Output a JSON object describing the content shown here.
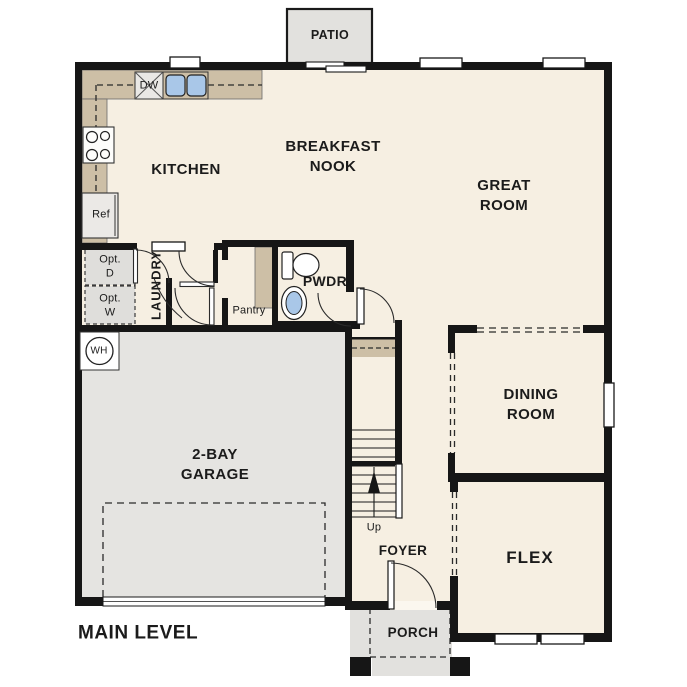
{
  "title": "MAIN LEVEL",
  "plan": {
    "level_label": "MAIN LEVEL",
    "rooms": {
      "patio": "PATIO",
      "kitchen": "KITCHEN",
      "breakfast_nook": "BREAKFAST\nNOOK",
      "great_room": "GREAT\nROOM",
      "laundry": "LAUNDRY",
      "pwdr": "PWDR",
      "pantry": "Pantry",
      "dining_room": "DINING\nROOM",
      "garage": "2-BAY\nGARAGE",
      "foyer": "FOYER",
      "flex": "FLEX",
      "porch": "PORCH"
    },
    "fixtures": {
      "dishwasher": "DW",
      "refrigerator": "Ref",
      "water_heater": "WH",
      "optional_dryer": "Opt.\nD",
      "optional_washer": "Opt.\nW",
      "stairs_direction": "Up"
    },
    "colors": {
      "floor": "#f6efe2",
      "garage_floor": "#e5e4e1",
      "outdoor_concrete": "#e2e1de",
      "counter": "#cdbfa6",
      "wall": "#161616",
      "sink_blue": "#a9c7e8",
      "optional_appliance_fill": "#dfdedb",
      "background": "#ffffff"
    }
  }
}
